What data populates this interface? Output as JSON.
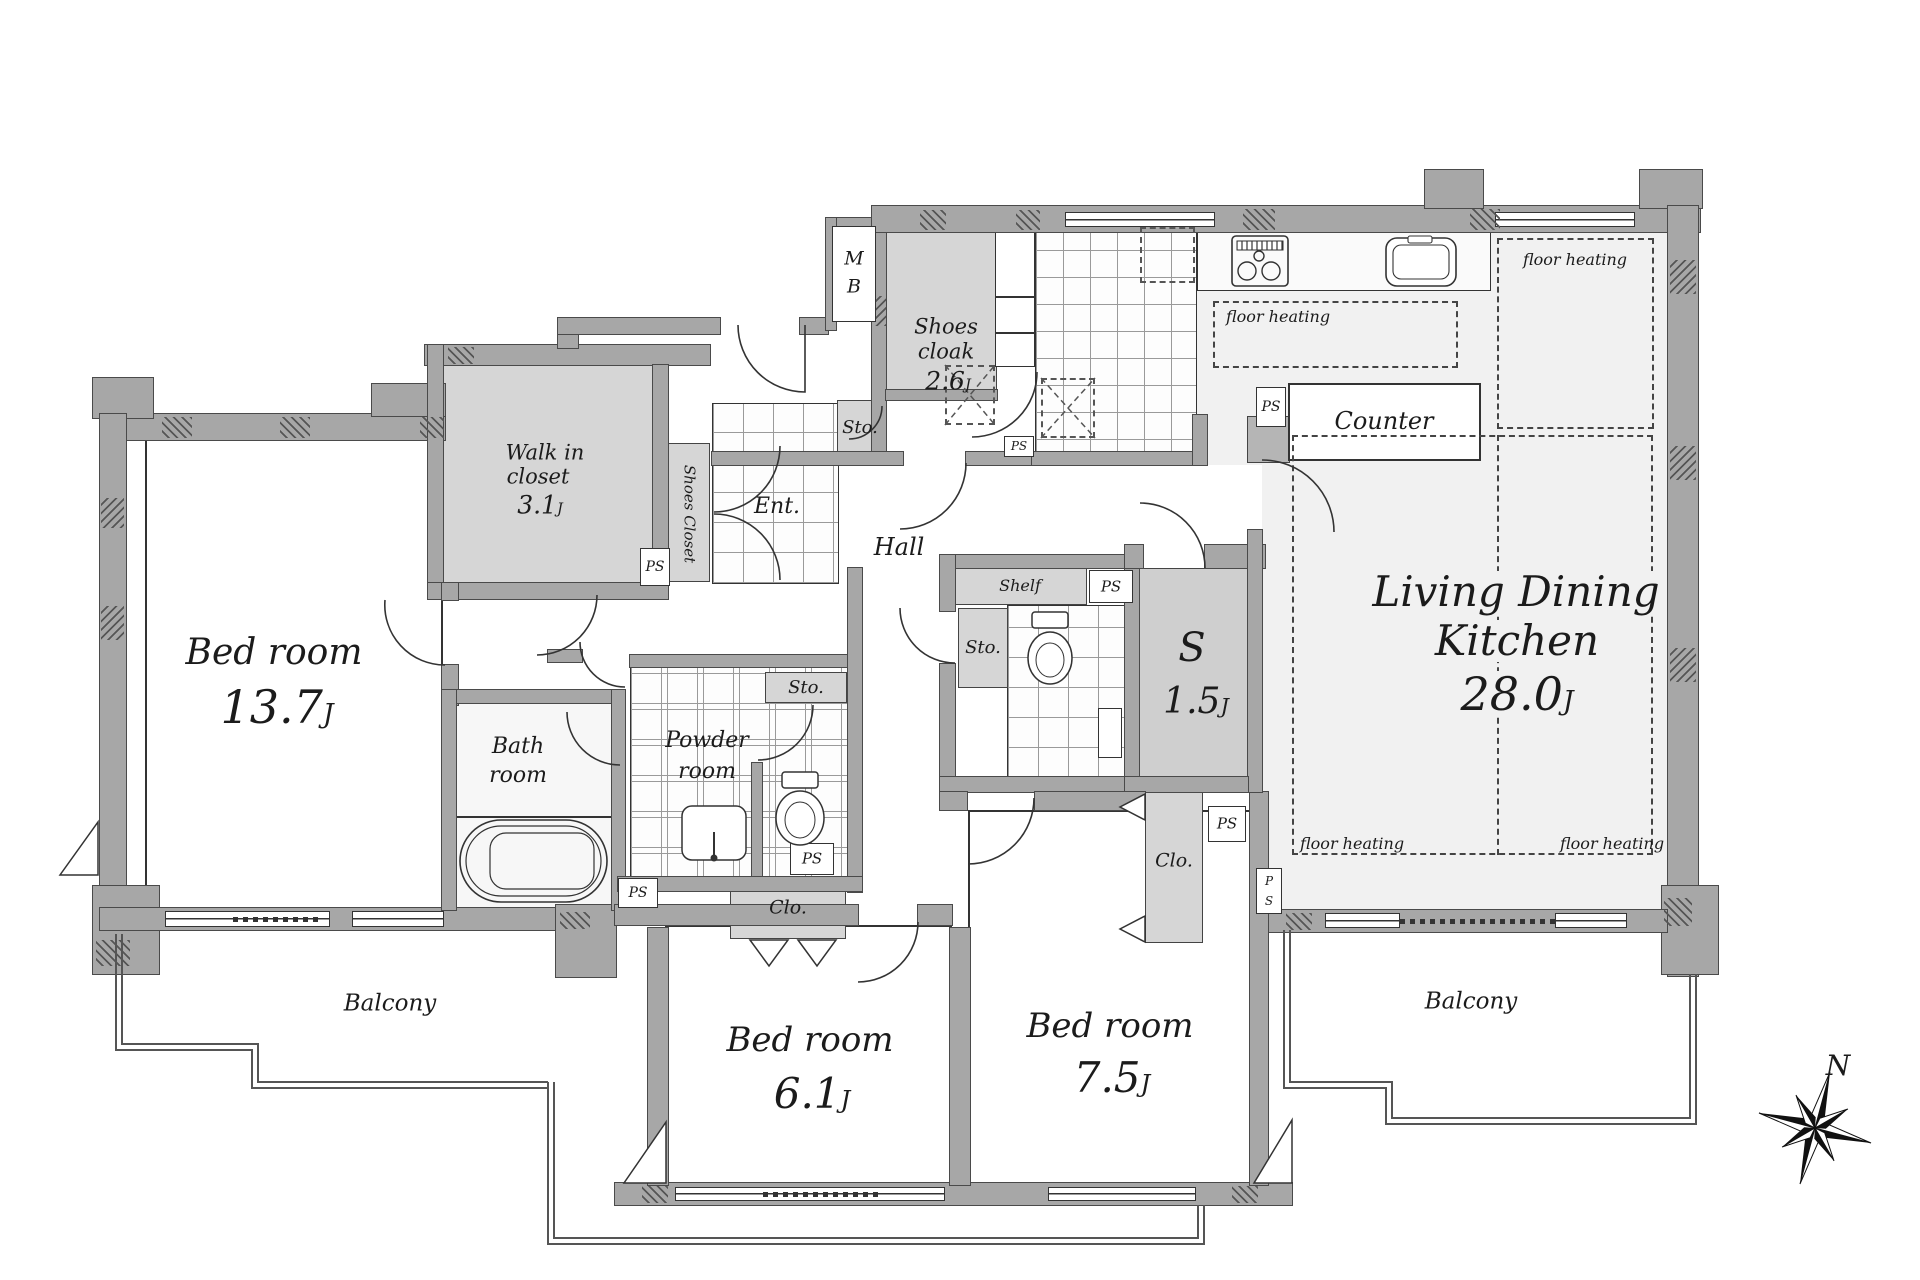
{
  "plan": {
    "rooms": {
      "bedroom_main": {
        "label": "Bed room",
        "area": "13.7",
        "unit": "J"
      },
      "bedroom_mid": {
        "label": "Bed room",
        "area": "6.1",
        "unit": "J"
      },
      "bedroom_right": {
        "label": "Bed room",
        "area": "7.5",
        "unit": "J"
      },
      "ldk": {
        "line1": "Living Dining",
        "line2": "Kitchen",
        "area": "28.0",
        "unit": "J"
      },
      "walk_in_closet": {
        "line1": "Walk in",
        "line2": "closet",
        "area": "3.1",
        "unit": "J"
      },
      "shoes_cloak": {
        "line1": "Shoes",
        "line2": "cloak",
        "area": "2.6",
        "unit": "J"
      },
      "service_room": {
        "label": "S",
        "area": "1.5",
        "unit": "J"
      },
      "bath": {
        "line1": "Bath",
        "line2": "room"
      },
      "powder": {
        "line1": "Powder",
        "line2": "room"
      },
      "entrance": {
        "label": "Ent."
      },
      "hall": {
        "label": "Hall"
      },
      "shoes_closet": {
        "label": "Shoes Closet"
      },
      "balcony": {
        "label": "Balcony"
      }
    },
    "fixtures": {
      "counter": "Counter",
      "shelf": "Shelf",
      "closet_abbr": "Clo.",
      "storage_abbr": "Sto.",
      "pipe_space": "PS",
      "ps_stacked_top": "P",
      "ps_stacked_bottom": "S",
      "meter_box_top": "M",
      "meter_box_bottom": "B",
      "floor_heating": "floor heating"
    },
    "compass": {
      "north": "N"
    }
  }
}
